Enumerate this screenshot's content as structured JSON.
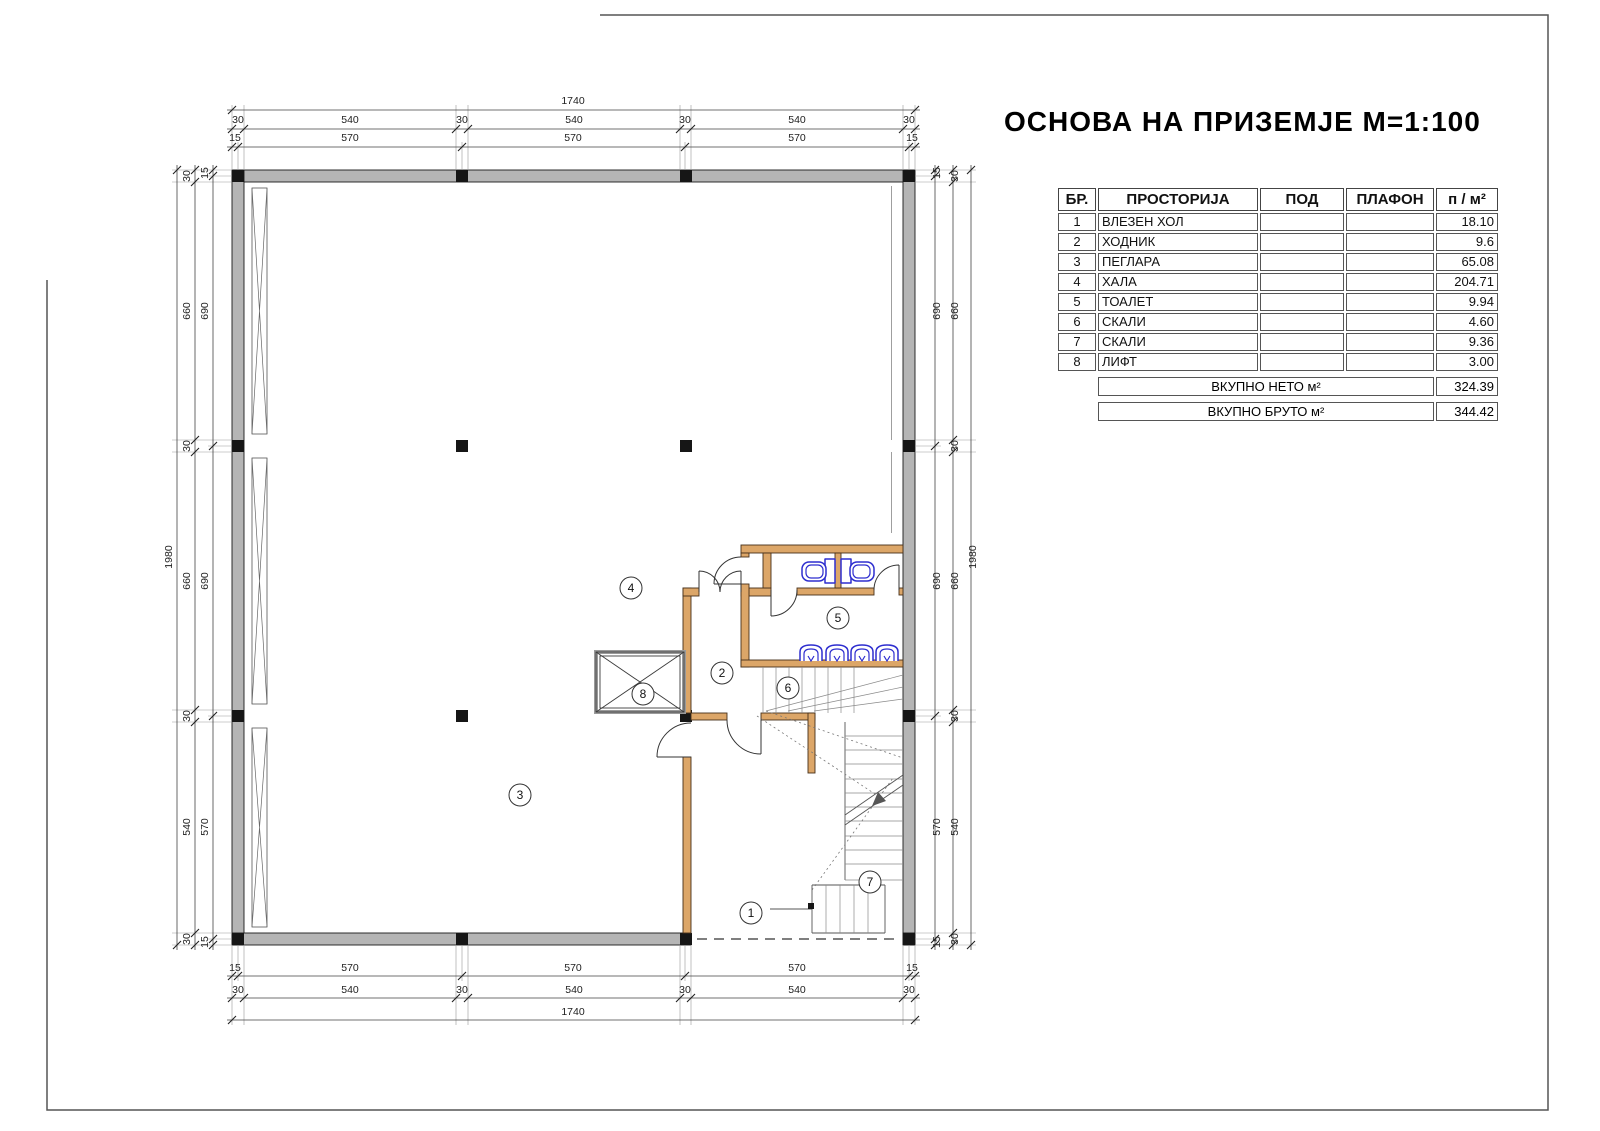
{
  "title": "ОСНОВА НА ПРИЗЕМЈЕ М=1:100",
  "table": {
    "headers": [
      "БР.",
      "ПРОСТОРИЈА",
      "ПОД",
      "ПЛАФОН",
      "п / м²"
    ],
    "rows": [
      {
        "num": "1",
        "name": "ВЛЕЗЕН ХОЛ",
        "pod": "",
        "plafon": "",
        "area": "18.10"
      },
      {
        "num": "2",
        "name": "ХОДНИК",
        "pod": "",
        "plafon": "",
        "area": "9.6"
      },
      {
        "num": "3",
        "name": "ПЕГЛАРА",
        "pod": "",
        "plafon": "",
        "area": "65.08"
      },
      {
        "num": "4",
        "name": "ХАЛА",
        "pod": "",
        "plafon": "",
        "area": "204.71"
      },
      {
        "num": "5",
        "name": "ТОАЛЕТ",
        "pod": "",
        "plafon": "",
        "area": "9.94"
      },
      {
        "num": "6",
        "name": "СКАЛИ",
        "pod": "",
        "plafon": "",
        "area": "4.60"
      },
      {
        "num": "7",
        "name": "СКАЛИ",
        "pod": "",
        "plafon": "",
        "area": "9.36"
      },
      {
        "num": "8",
        "name": "ЛИФТ",
        "pod": "",
        "plafon": "",
        "area": "3.00"
      }
    ],
    "totals": [
      {
        "label": "ВКУПНО НЕТО м²",
        "value": "324.39"
      },
      {
        "label": "ВКУПНО БРУТО м²",
        "value": "344.42"
      }
    ]
  },
  "plan": {
    "room_numbers": [
      "1",
      "2",
      "3",
      "4",
      "5",
      "6",
      "7",
      "8"
    ],
    "dims": {
      "top": {
        "overall": "1740",
        "mid": [
          "30",
          "540",
          "30",
          "540",
          "30",
          "540",
          "30"
        ],
        "inner": [
          "15",
          "570",
          "570",
          "570",
          "15"
        ]
      },
      "bottom": {
        "inner": [
          "15",
          "570",
          "570",
          "570",
          "15"
        ],
        "mid": [
          "30",
          "540",
          "30",
          "540",
          "30",
          "540",
          "30"
        ],
        "overall": "1740"
      },
      "left": {
        "overall": "1980",
        "mid": [
          "30",
          "660",
          "30",
          "660",
          "30",
          "540",
          "30"
        ],
        "inner": [
          "15",
          "690",
          "690",
          "570",
          "15"
        ]
      },
      "right": {
        "inner": [
          "15",
          "690",
          "690",
          "570",
          "15"
        ],
        "mid": [
          "30",
          "660",
          "30",
          "660",
          "30",
          "540",
          "30"
        ],
        "overall": "1980"
      }
    }
  },
  "colors": {
    "wall_fill": "#b5b5b5",
    "partition_fill": "#dca668",
    "fixture_blue": "#2e2ecf",
    "column_black": "#161616"
  }
}
